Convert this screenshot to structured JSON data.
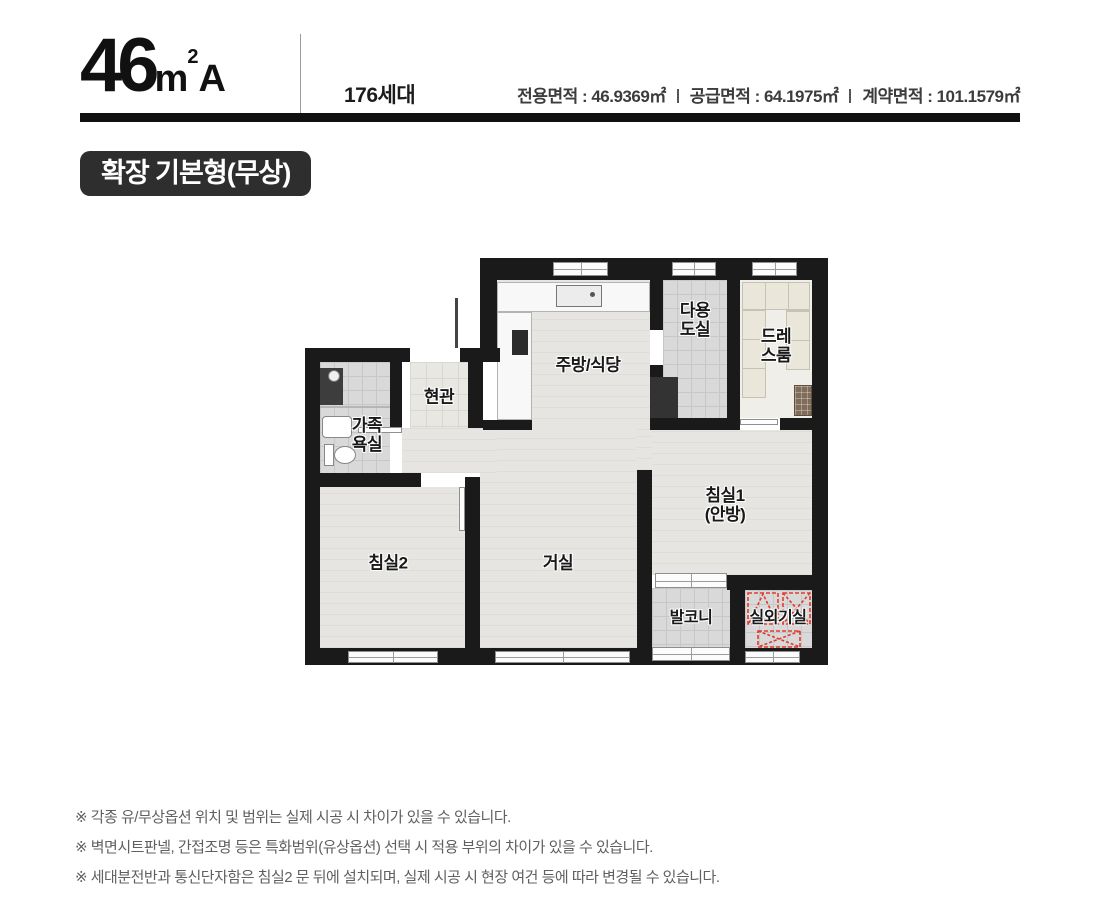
{
  "header": {
    "unit": {
      "big": "46",
      "small": "m",
      "sup": "2",
      "tail": "A"
    },
    "households": "176세대",
    "areas": [
      "전용면적 : 46.9369㎡",
      "공급면적 : 64.1975㎡",
      "계약면적 : 101.1579㎡"
    ]
  },
  "badge": {
    "label": "확장 기본형(무상)"
  },
  "plan": {
    "rooms": [
      {
        "name": "kitchen-dining",
        "lines": [
          "주방/식당"
        ]
      },
      {
        "name": "utility-room",
        "lines": [
          "다용",
          "도실"
        ]
      },
      {
        "name": "dress-room",
        "lines": [
          "드레",
          "스룸"
        ]
      },
      {
        "name": "entrance",
        "lines": [
          "현관"
        ]
      },
      {
        "name": "family-bath",
        "lines": [
          "가족",
          "욕실"
        ]
      },
      {
        "name": "bedroom2",
        "lines": [
          "침실2"
        ]
      },
      {
        "name": "living-room",
        "lines": [
          "거실"
        ]
      },
      {
        "name": "bedroom1",
        "lines": [
          "침실1",
          "(안방)"
        ]
      },
      {
        "name": "balcony",
        "lines": [
          "발코니"
        ]
      },
      {
        "name": "outdoor-unit-room",
        "lines": [
          "실외기실"
        ]
      }
    ]
  },
  "footnotes": [
    "※ 각종 유/무상옵션 위치 및 범위는 실제 시공 시 차이가 있을 수 있습니다.",
    "※ 벽면시트판넬, 간접조명 등은 특화범위(유상옵션) 선택 시 적용 부위의 차이가 있을 수 있습니다.",
    "※ 세대분전반과 통신단자함은 침실2 문 뒤에 설치되며, 실제 시공 시 현장 여건 등에 따라 변경될 수 있습니다."
  ],
  "colors": {
    "wall": "#1a1a1a",
    "badge_bg": "#2e2e2e",
    "accent_red": "#e23a2e"
  }
}
